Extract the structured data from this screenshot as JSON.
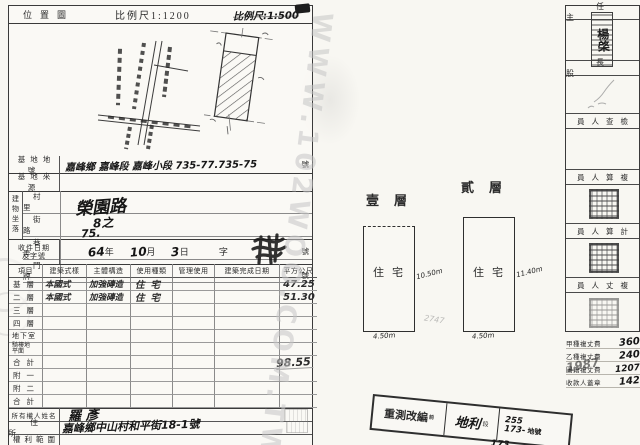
{
  "watermark": "WWW.102WOO.COM.TW",
  "header": {
    "title": "位置圖",
    "scale_printed": "比例尺1:1200",
    "scale_hand": "比例尺:1:500"
  },
  "site": {
    "parcel_label": "基地地號",
    "parcel_value": "嘉峰鄉 嘉峰段 嘉峰小段 735-77.735-75",
    "parcel_unit": "號",
    "source_label": "基地來源"
  },
  "location": {
    "block_label": "建物坐落",
    "rows": [
      {
        "label": "村里",
        "value": ""
      },
      {
        "label": "街路",
        "value": "榮園路"
      },
      {
        "label": "巷弄",
        "value": "8之"
      },
      {
        "label": "門牌",
        "value": "75.",
        "unit": "號"
      }
    ]
  },
  "intake": {
    "label_line1": "收件日期",
    "label_line2": "及字號",
    "year": "64",
    "year_unit": "年",
    "month": "10",
    "month_unit": "月",
    "day": "3",
    "day_unit": "日",
    "zi": "字",
    "hao": "號"
  },
  "table": {
    "headers": [
      "項目",
      "建築式樣",
      "主體構造",
      "使用種類",
      "管理使用",
      "建築完成日期",
      "平方公尺"
    ],
    "rows": [
      {
        "label": "基層",
        "style": "本國式",
        "structure": "加強磚造",
        "use": "住宅",
        "area": "47.25"
      },
      {
        "label": "二層",
        "style": "本國式",
        "structure": "加強磚造",
        "use": "住宅",
        "area": "51.30"
      },
      {
        "label": "三層"
      },
      {
        "label": "四層"
      },
      {
        "label": "地下室"
      },
      {
        "label": "騎樓地",
        "label2": "平面"
      },
      {
        "label": "合計",
        "area": "98.55"
      },
      {
        "label": "附一"
      },
      {
        "label": "附二"
      },
      {
        "label": "合計"
      }
    ]
  },
  "owner": {
    "name_label": "所有權人姓名",
    "name": "羅 彥",
    "address_label": "住所",
    "address": "嘉峰鄉中山村和平街18-1號",
    "rights_label": "權利範圍"
  },
  "plans": {
    "floor1": {
      "title": "壹層",
      "use": "住宅",
      "height_dim": "10.50m",
      "width_dim": "4.50m"
    },
    "floor2": {
      "title": "貳層",
      "use": "住宅",
      "height_dim": "11.40m",
      "width_dim": "4.50m"
    },
    "pencil_note": "2747"
  },
  "officials": {
    "chief": "任主",
    "section_head": "長股",
    "inspector": "員人查檢",
    "recheck_calc": "員人算複",
    "calculator": "員人算計",
    "resurveyor": "員人丈複",
    "seal_name": "楊棨"
  },
  "fees": {
    "items": [
      {
        "label": "甲種複丈費",
        "value": "360"
      },
      {
        "label": "乙種複丈費",
        "value": "240"
      },
      {
        "label": "圖籍複丈費",
        "value": "1207"
      },
      {
        "label": "收款人蓋章",
        "value": "142"
      }
    ],
    "overstamp": "1987"
  },
  "restamp": {
    "seg1": "重測改編",
    "seg1_small": "前",
    "seg2": "地利",
    "seg2_small": "段",
    "num1": "255",
    "num2": "173-",
    "num_unit": "地號",
    "below": "173"
  }
}
